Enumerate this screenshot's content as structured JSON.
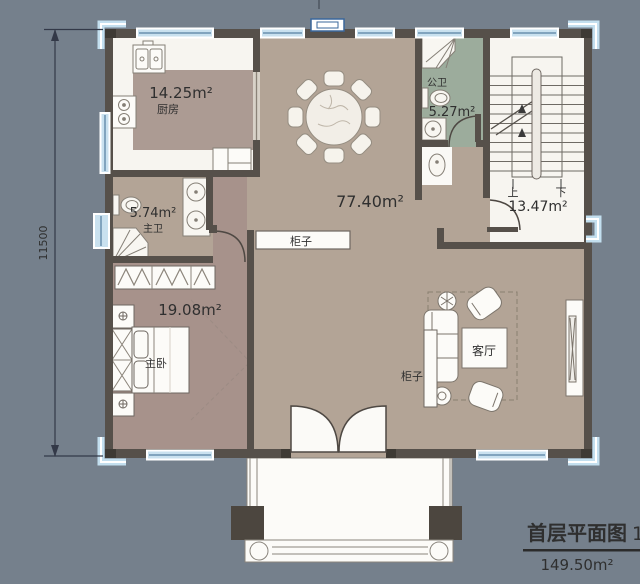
{
  "palette": {
    "background": "#75808C",
    "wall": "#56504A",
    "wall_dark": "#3E3A34",
    "floor_hall_tan": "#B3A496",
    "floor_kitchen_rug": "#AC9B93",
    "floor_bedroom_mauve": "#A7928B",
    "floor_bath_green": "#9CAC9C",
    "floor_white": "#F7F5F0",
    "window_blue": "#C9E1EF",
    "pillar_blue": "#C3DFEF",
    "text": "#2F2F2F"
  },
  "rooms": [
    {
      "id": "kitchen",
      "name": "厨房",
      "area": "14.25m²"
    },
    {
      "id": "public-bathroom",
      "name": "公卫",
      "area": "5.27m²"
    },
    {
      "id": "hall-dining",
      "area": "77.40m²"
    },
    {
      "id": "stairwell",
      "area": "13.47m²",
      "up_label": "上",
      "down_label": "下"
    },
    {
      "id": "master-bathroom",
      "name": "主卫",
      "area": "5.74m²"
    },
    {
      "id": "master-bedroom",
      "name": "主卧",
      "area": "19.08m²"
    },
    {
      "id": "living-room",
      "name": "客厅"
    }
  ],
  "furniture": {
    "cabinet_hall": "柜子",
    "cabinet_living": "柜子"
  },
  "dimensions": {
    "left_total": "11500"
  },
  "title_block": {
    "title": "首层平面图",
    "scale_fragment": "1",
    "total_area": "149.50m²"
  }
}
